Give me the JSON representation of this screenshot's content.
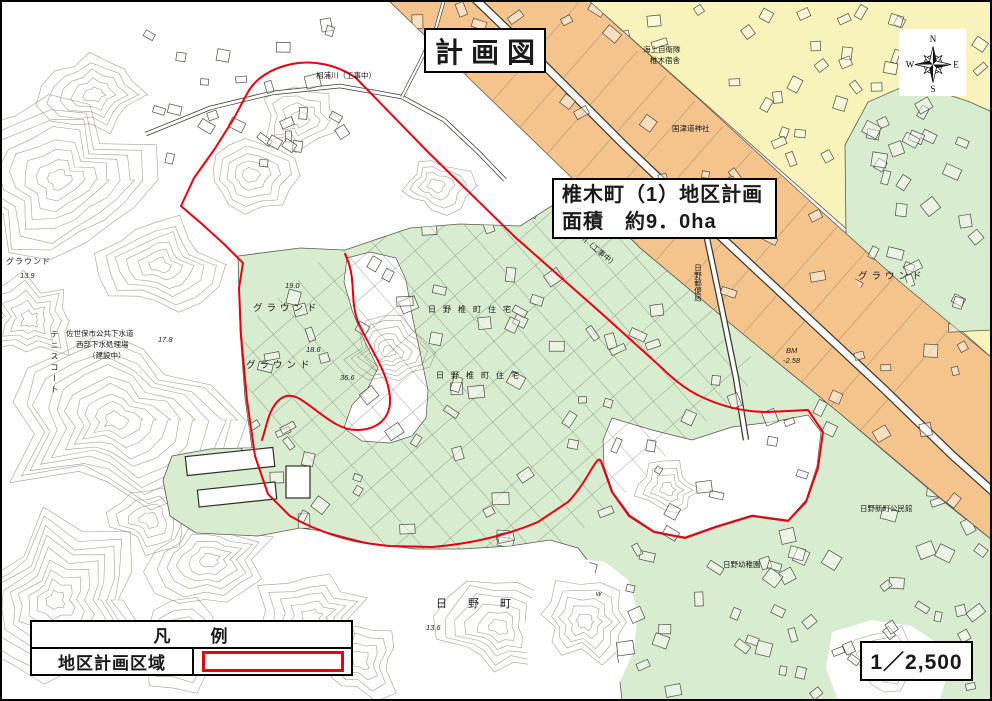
{
  "title_box": {
    "text": "計画図"
  },
  "info_box": {
    "line1": "椎木町（1）地区計画",
    "line2": "面積　約9．0ha"
  },
  "compass": {
    "n": "N",
    "e": "E",
    "s": "S",
    "w": "W"
  },
  "legend": {
    "header": "凡　　例",
    "row_label": "地区計画区域"
  },
  "scale_box": {
    "text": "1／2,500"
  },
  "colors": {
    "district_boundary": "#e60012",
    "zone_orange": "#f4c48c",
    "zone_yellow": "#f8f3ba",
    "zone_green": "#d8ecd0",
    "contour": "#8d8a78",
    "ink": "#1a1a1a",
    "paper": "#ffffff"
  },
  "map": {
    "labels": [
      {
        "text": "グラウンド"
      },
      {
        "text": "グラウンド"
      },
      {
        "text": "グラウンド"
      },
      {
        "text": "テニスコート"
      },
      {
        "text": "佐世保市公共下水道"
      },
      {
        "text": "西部下水処理場"
      },
      {
        "text": "（建設中）"
      },
      {
        "text": "海上自衛隊"
      },
      {
        "text": "椎木宿舎"
      },
      {
        "text": "国津道神社"
      },
      {
        "text": "日野郵便局"
      },
      {
        "text": "日野椎町住宅"
      },
      {
        "text": "日野椎町住宅"
      },
      {
        "text": "日　野　町"
      },
      {
        "text": "日野幼稚園"
      },
      {
        "text": "日野新町公民館"
      },
      {
        "text": "相浦川（工事中）"
      },
      {
        "text": "川之上川（工事中）"
      },
      {
        "text": "BM"
      },
      {
        "text": "-2.58"
      },
      {
        "text": "19.0"
      },
      {
        "text": "18.6"
      },
      {
        "text": "36.6"
      },
      {
        "text": "w"
      },
      {
        "text": "17.8"
      },
      {
        "text": "13.6"
      },
      {
        "text": "13.9"
      },
      {
        "text": "グラウンド"
      }
    ]
  }
}
